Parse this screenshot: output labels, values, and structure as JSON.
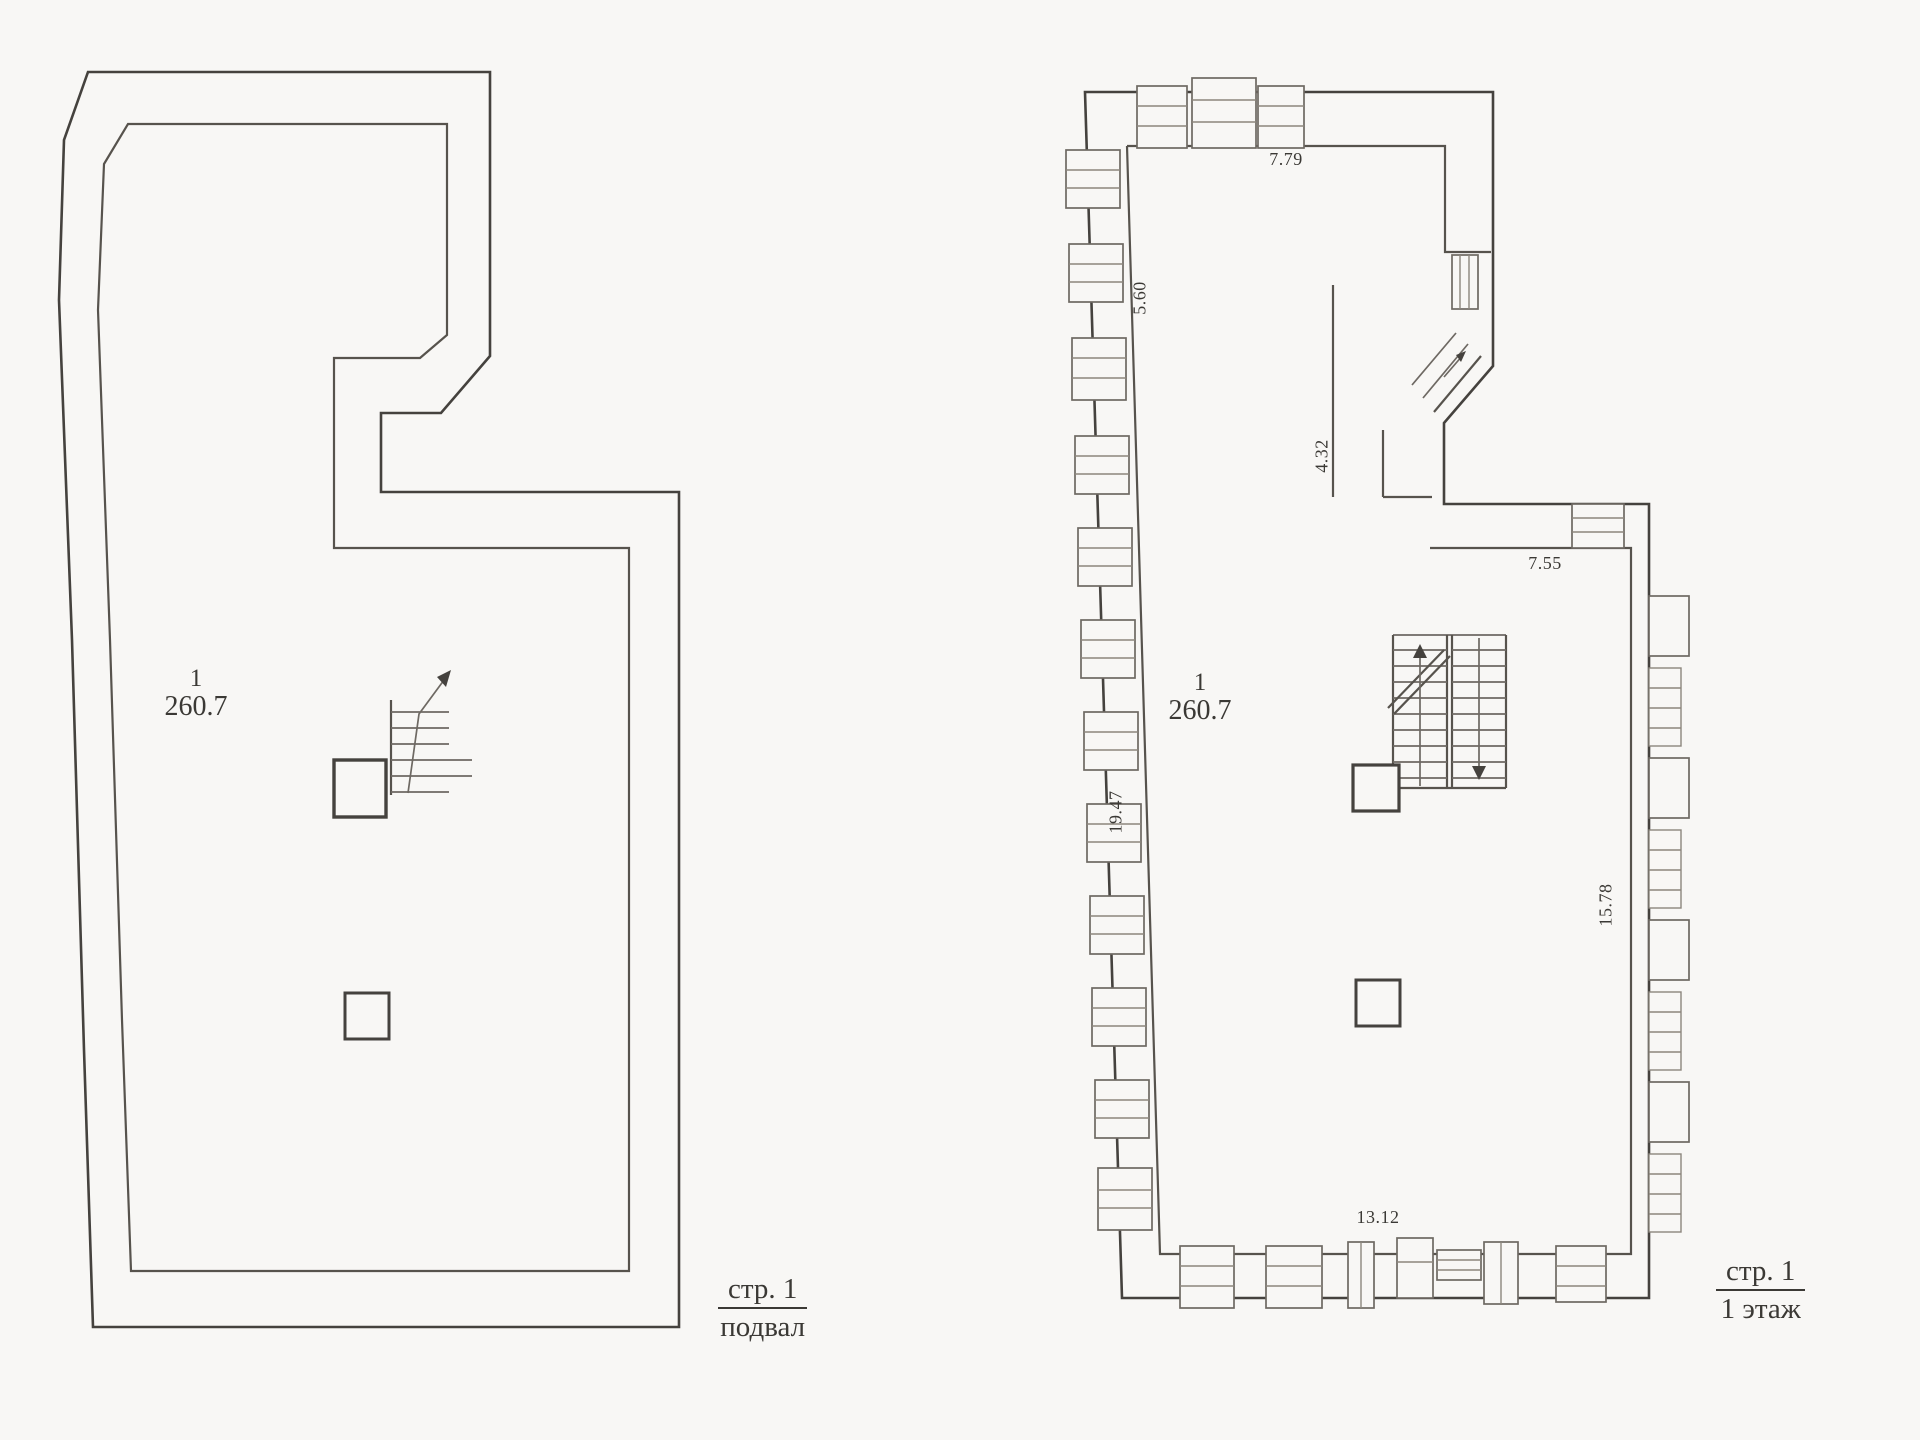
{
  "colors": {
    "ink": "#45423e",
    "paper": "#f8f7f5"
  },
  "basement": {
    "room_number": "1",
    "room_area": "260.7",
    "caption_top": "стр. 1",
    "caption_bottom": "подвал"
  },
  "first_floor": {
    "room_number": "1",
    "room_area": "260.7",
    "caption_top": "стр. 1",
    "caption_bottom": "1 этаж",
    "dim_top": "7.79",
    "dim_upper_left": "5.60",
    "dim_stair_wall": "4.32",
    "dim_upper_right": "7.55",
    "dim_left": "19.47",
    "dim_right": "15.78",
    "dim_bottom": "13.12"
  },
  "symbols": {
    "basement_stair": "staircase-up-arrow",
    "first_floor_stair": "double-flight-staircase",
    "pillars": "square-column"
  }
}
